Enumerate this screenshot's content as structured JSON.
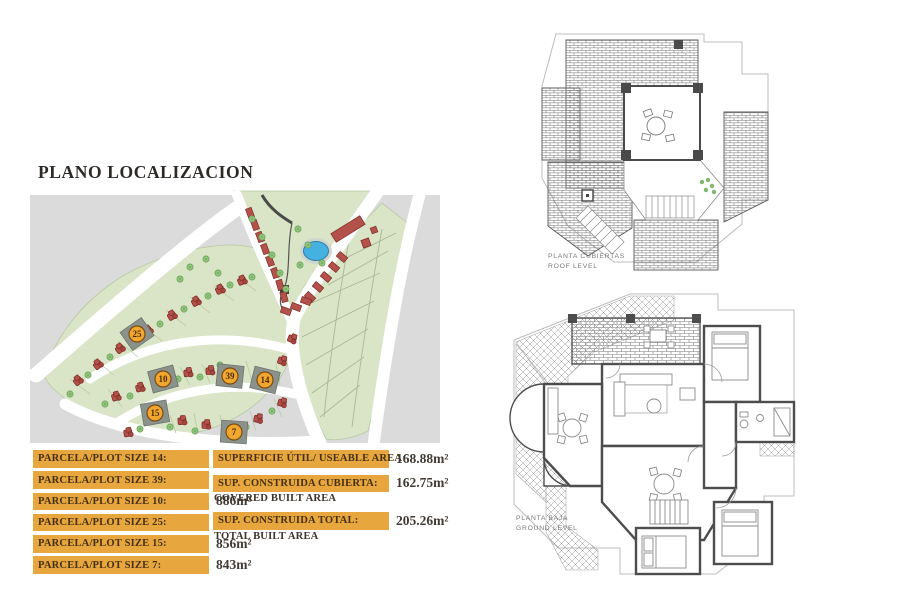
{
  "title": "PLANO LOCALIZACION",
  "colors": {
    "accent_orange": "#e7a73e",
    "badge_orange": "#f1a62e",
    "map_green": "#d9e5c6",
    "map_gray": "#dbdbdb",
    "house_red": "#b4514a",
    "pool_blue": "#45b1e0",
    "highlight_plot_gray": "#8b918b"
  },
  "map": {
    "badges": [
      {
        "number": "25"
      },
      {
        "number": "10"
      },
      {
        "number": "15"
      },
      {
        "number": "39"
      },
      {
        "number": "14"
      },
      {
        "number": "7"
      }
    ]
  },
  "plots_table": {
    "rows": [
      {
        "label": "PARCELA/PLOT SIZE 14:",
        "value": "818m²"
      },
      {
        "label": "PARCELA/PLOT SIZE 39:",
        "value": "859m²"
      },
      {
        "label": "PARCELA/PLOT SIZE 10:",
        "value": "886m²"
      },
      {
        "label": "PARCELA/PLOT SIZE 25:",
        "value": "846m²"
      },
      {
        "label": "PARCELA/PLOT SIZE 15:",
        "value": "856m²"
      },
      {
        "label": "PARCELA/PLOT SIZE 7:",
        "value": "843m²"
      }
    ]
  },
  "summary_table": {
    "rows": [
      {
        "label": "SUPERFICIE ÚTIL/ USEABLE AREA:",
        "sublabel": "",
        "value": "168.88m²"
      },
      {
        "label": "SUP. CONSTRUIDA CUBIERTA:",
        "sublabel": "COVERED BUILT AREA",
        "value": "162.75m²"
      },
      {
        "label": "SUP. CONSTRUIDA TOTAL:",
        "sublabel": "TOTAL BUILT AREA",
        "value": "205.26m²"
      }
    ]
  },
  "floor_plans": {
    "roof": {
      "label_line1": "PLANTA CUBIERTAS",
      "label_line2": "ROOF LEVEL"
    },
    "ground": {
      "label_line1": "PLANTA BAJA",
      "label_line2": "GROUND LEVEL"
    }
  }
}
